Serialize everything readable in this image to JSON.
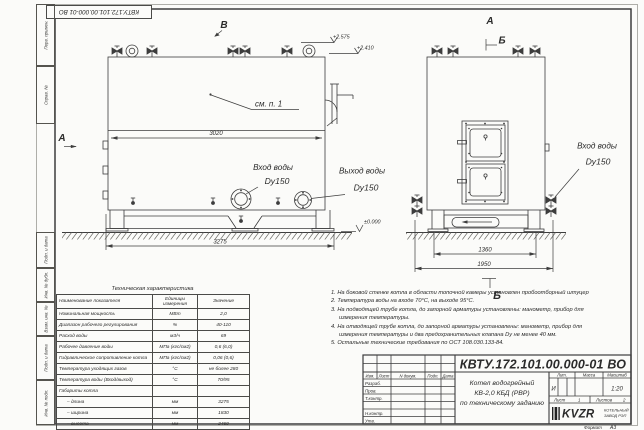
{
  "stamp_corner": "КВТУ.172.101.00.000-01 ВО",
  "sidebar": {
    "labels": [
      "Перв. примен.",
      "Справ. №",
      "Подп. и дата",
      "Инв. № дубл.",
      "Взам. инв. №",
      "Подп. и дата",
      "Инв. № подл."
    ]
  },
  "drawing": {
    "front": {
      "letter_top": "В",
      "letter_left": "А",
      "see_ref": "см. п. 1",
      "dim_inner": "3020",
      "dim_base": "3275",
      "elev1": "+2.575",
      "elev2": "+2.410",
      "elev_zero": "±0.000",
      "inlet_line1": "Вход воды",
      "inlet_line2": "Dy150",
      "outlet_line1": "Выход воды",
      "outlet_line2": "Dy150"
    },
    "side": {
      "letter_top": "А",
      "section_top": "Б",
      "section_bottom": "Б",
      "dim_inner": "1360",
      "dim_outer": "1950",
      "inlet_line1": "Вход воды",
      "inlet_line2": "Dy150"
    }
  },
  "notes": {
    "lines": [
      "1.  На боковой стенке котла в области топочной камеры установлен пробоотборный штуцер",
      "2.  Температура воды на входе 70°С, на выходе 95°С.",
      "3.  На подводящей трубе котла, до запорной арматуры установлены: манометр, прибор для",
      "измерения температуры.",
      "4.  На отводящей трубе котла, до запорной арматуры установлены: манометр, прибор для",
      "измерения температуры и два предохранительных клапана Dу не менее 40 мм.",
      "5.  Остальные технические требования по ОСТ 108.030.133-84."
    ]
  },
  "spec": {
    "title": "Техническая характеристика",
    "col1": "Наименование показателя",
    "col2": "Единицы измерения",
    "col3": "Значение",
    "rows": [
      [
        "Номинальная мощность",
        "МВт",
        "2,0"
      ],
      [
        "Диапазон рабочего регулирования",
        "%",
        "40-110"
      ],
      [
        "Расход воды",
        "м3/ч",
        "69"
      ],
      [
        "Рабочее давление воды",
        "МПа (кгс/см2)",
        "0,6 (6,0)"
      ],
      [
        "Гидравлическое сопротивление котла",
        "МПа (кгс/см2)",
        "0,06 (0,6)"
      ],
      [
        "Температура уходящих газов",
        "°С",
        "не более 280"
      ],
      [
        "Температура воды (Вход/выход)",
        "°С",
        "70/95"
      ],
      [
        "Габариты котла",
        "",
        ""
      ],
      [
        "– длина",
        "мм",
        "3275"
      ],
      [
        "– ширина",
        "мм",
        "1830"
      ],
      [
        "– высота",
        "мм",
        "2460"
      ]
    ]
  },
  "title_block": {
    "designation": "КВТУ.172.101.00.000-01 ВО",
    "rev_cols": [
      "Изм.",
      "Лист",
      "N докум.",
      "Подп.",
      "Дата"
    ],
    "roles": [
      "Разраб.",
      "Пров.",
      "Т.контр.",
      "Н.контр.",
      "Утв."
    ],
    "doc_title": [
      "Котел водогрейный",
      "КВ-2,0 КБД (РВР)",
      "по техническому заданию"
    ],
    "lit_label": "Лит.",
    "mass_label": "Масса",
    "scale_label": "Масштаб",
    "lit_value": "И",
    "scale_value": "1:20",
    "sheet_label": "Лист",
    "sheet_value": "1",
    "sheets_label": "Листов",
    "sheets_value": "2",
    "logo": "KVZR",
    "logo_sub1": "КОТЕЛЬНЫЙ",
    "logo_sub2": "ЗАВОД РЭП",
    "format_label": "Формат",
    "format_value": "А3"
  }
}
